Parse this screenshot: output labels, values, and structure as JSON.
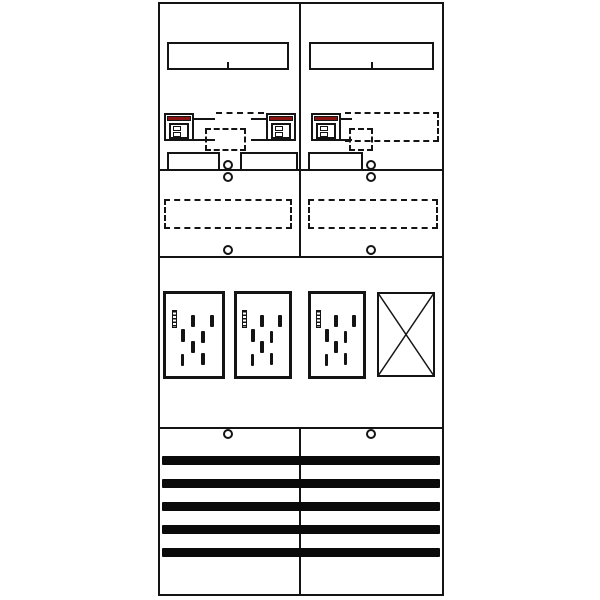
{
  "meta": {
    "drawing_type": "meter-cabinet-panel-layout",
    "columns": 2,
    "background_color": "#ffffff",
    "line_color": "#141414",
    "accent_red": "#8b1412"
  },
  "components": {
    "din_rails": 2,
    "red_top_devices": 3,
    "meter_plates": 3,
    "reserve_plates": 1,
    "terminal_strips": 3,
    "dashed_reserved_areas": 5,
    "busbar_cover_bars": 5,
    "screw_count": 8
  },
  "rails": {
    "left": 11,
    "right": 12
  },
  "strips": [
    {
      "cells": 6
    },
    {
      "cells": 6
    },
    {
      "cells": 6
    }
  ],
  "screw_circles": [
    [
      228,
      165
    ],
    [
      371,
      165
    ],
    [
      228,
      177
    ],
    [
      371,
      177
    ],
    [
      228,
      250
    ],
    [
      371,
      250
    ],
    [
      228,
      434
    ],
    [
      371,
      434
    ]
  ],
  "meter_plates": {
    "count": 3,
    "slot": {
      "x": 10,
      "y": 19,
      "w": 9,
      "h": 22
    },
    "dashes": [
      [
        45,
        25
      ],
      [
        79,
        25
      ],
      [
        27,
        43
      ],
      [
        63,
        45
      ],
      [
        45,
        57
      ],
      [
        26,
        73
      ],
      [
        63,
        72
      ]
    ],
    "dash_size": {
      "w": 7,
      "h": 15
    }
  },
  "bottom_bars": {
    "x": 162,
    "width": 278,
    "height": 9,
    "y_positions": [
      456,
      479,
      502,
      525,
      548
    ]
  }
}
